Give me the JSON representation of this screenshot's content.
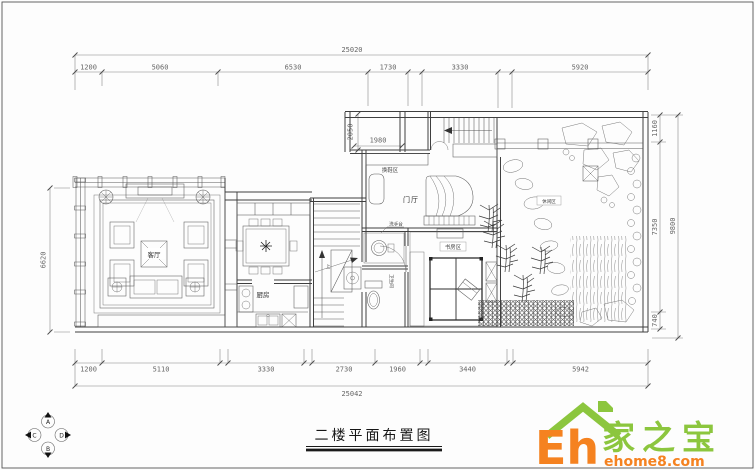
{
  "title_block": {
    "title": "二楼平面布置图"
  },
  "dims": {
    "top": {
      "overall": "25020",
      "segs": [
        "1200",
        "5060",
        "6530",
        "1730",
        "3330",
        "5920"
      ]
    },
    "bottom": {
      "overall": "25042",
      "segs": [
        "1200",
        "5110",
        "3330",
        "2730",
        "1960",
        "3440",
        "5942"
      ]
    },
    "left": {
      "overall": "6620"
    },
    "right": {
      "overall": "9800",
      "segs": [
        "1160",
        "7350",
        "740"
      ]
    },
    "inner": {
      "alcove_width": "1980",
      "alcove_depth": "2050"
    }
  },
  "labels": {
    "living": "客厅",
    "kitchen": "厨房",
    "foyer": "门厅",
    "shoe_area": "换鞋区",
    "study": "书房区",
    "bath": "卫生间",
    "basin": "洗手台",
    "leisure": "休闲区",
    "stair_up": "上"
  },
  "elevation_symbol": {
    "n": "A",
    "s": "B",
    "w": "C",
    "e": "D"
  },
  "logo": {
    "brand_short": "Eh",
    "brand_cn": "家之宝",
    "site": "ehome8.com",
    "green": "#8CC63E",
    "orange": "#F58220"
  },
  "colors": {
    "line": "#3f3f3f",
    "dim_text": "#666666"
  }
}
